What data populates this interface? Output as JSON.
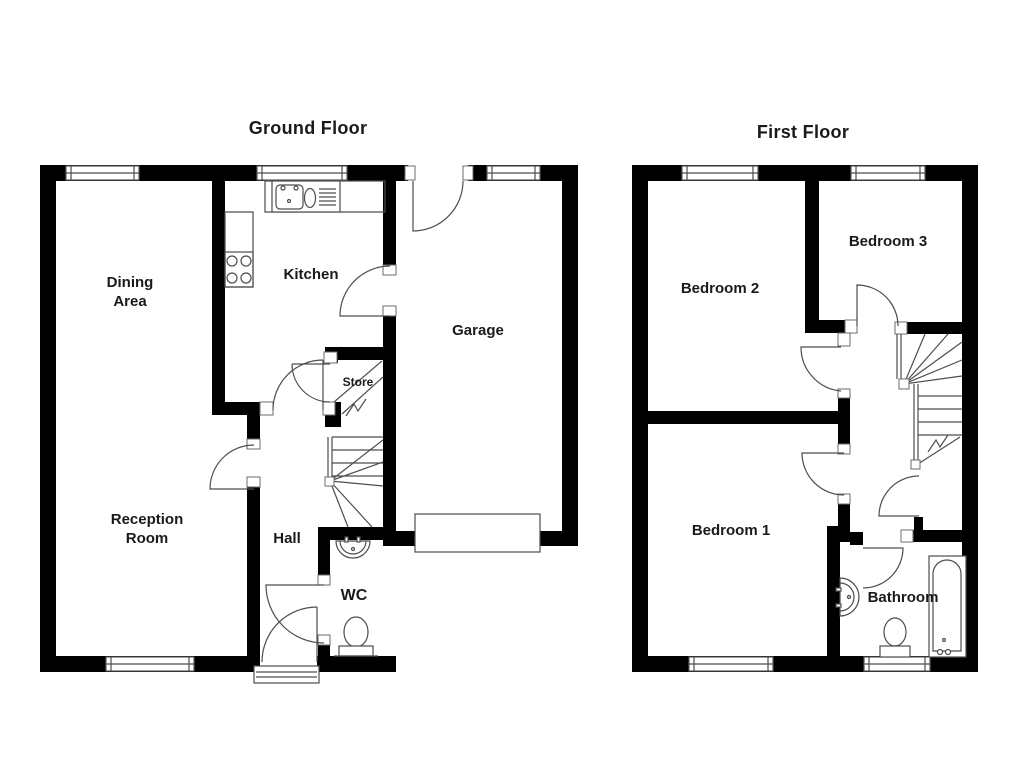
{
  "ground_floor": {
    "title": "Ground Floor",
    "rooms": {
      "dining_line1": "Dining",
      "dining_line2": "Area",
      "kitchen": "Kitchen",
      "garage": "Garage",
      "store": "Store",
      "reception_line1": "Reception",
      "reception_line2": "Room",
      "hall": "Hall",
      "wc": "WC"
    }
  },
  "first_floor": {
    "title": "First Floor",
    "rooms": {
      "bedroom2": "Bedroom 2",
      "bedroom3": "Bedroom 3",
      "bedroom1": "Bedroom 1",
      "bathroom": "Bathroom"
    }
  },
  "colors": {
    "wall": "#000000",
    "line": "#4d4d4d",
    "text": "#1a1a1a",
    "background": "#ffffff"
  },
  "fixtures": {
    "ground": [
      "kitchen-sink",
      "kitchen-hob",
      "kitchen-counter",
      "wc-basin",
      "wc-toilet",
      "staircase",
      "garage-door",
      "front-door-threshold"
    ],
    "first": [
      "bathroom-basin",
      "bathroom-toilet",
      "bathtub",
      "staircase",
      "landing-cupboard"
    ]
  }
}
